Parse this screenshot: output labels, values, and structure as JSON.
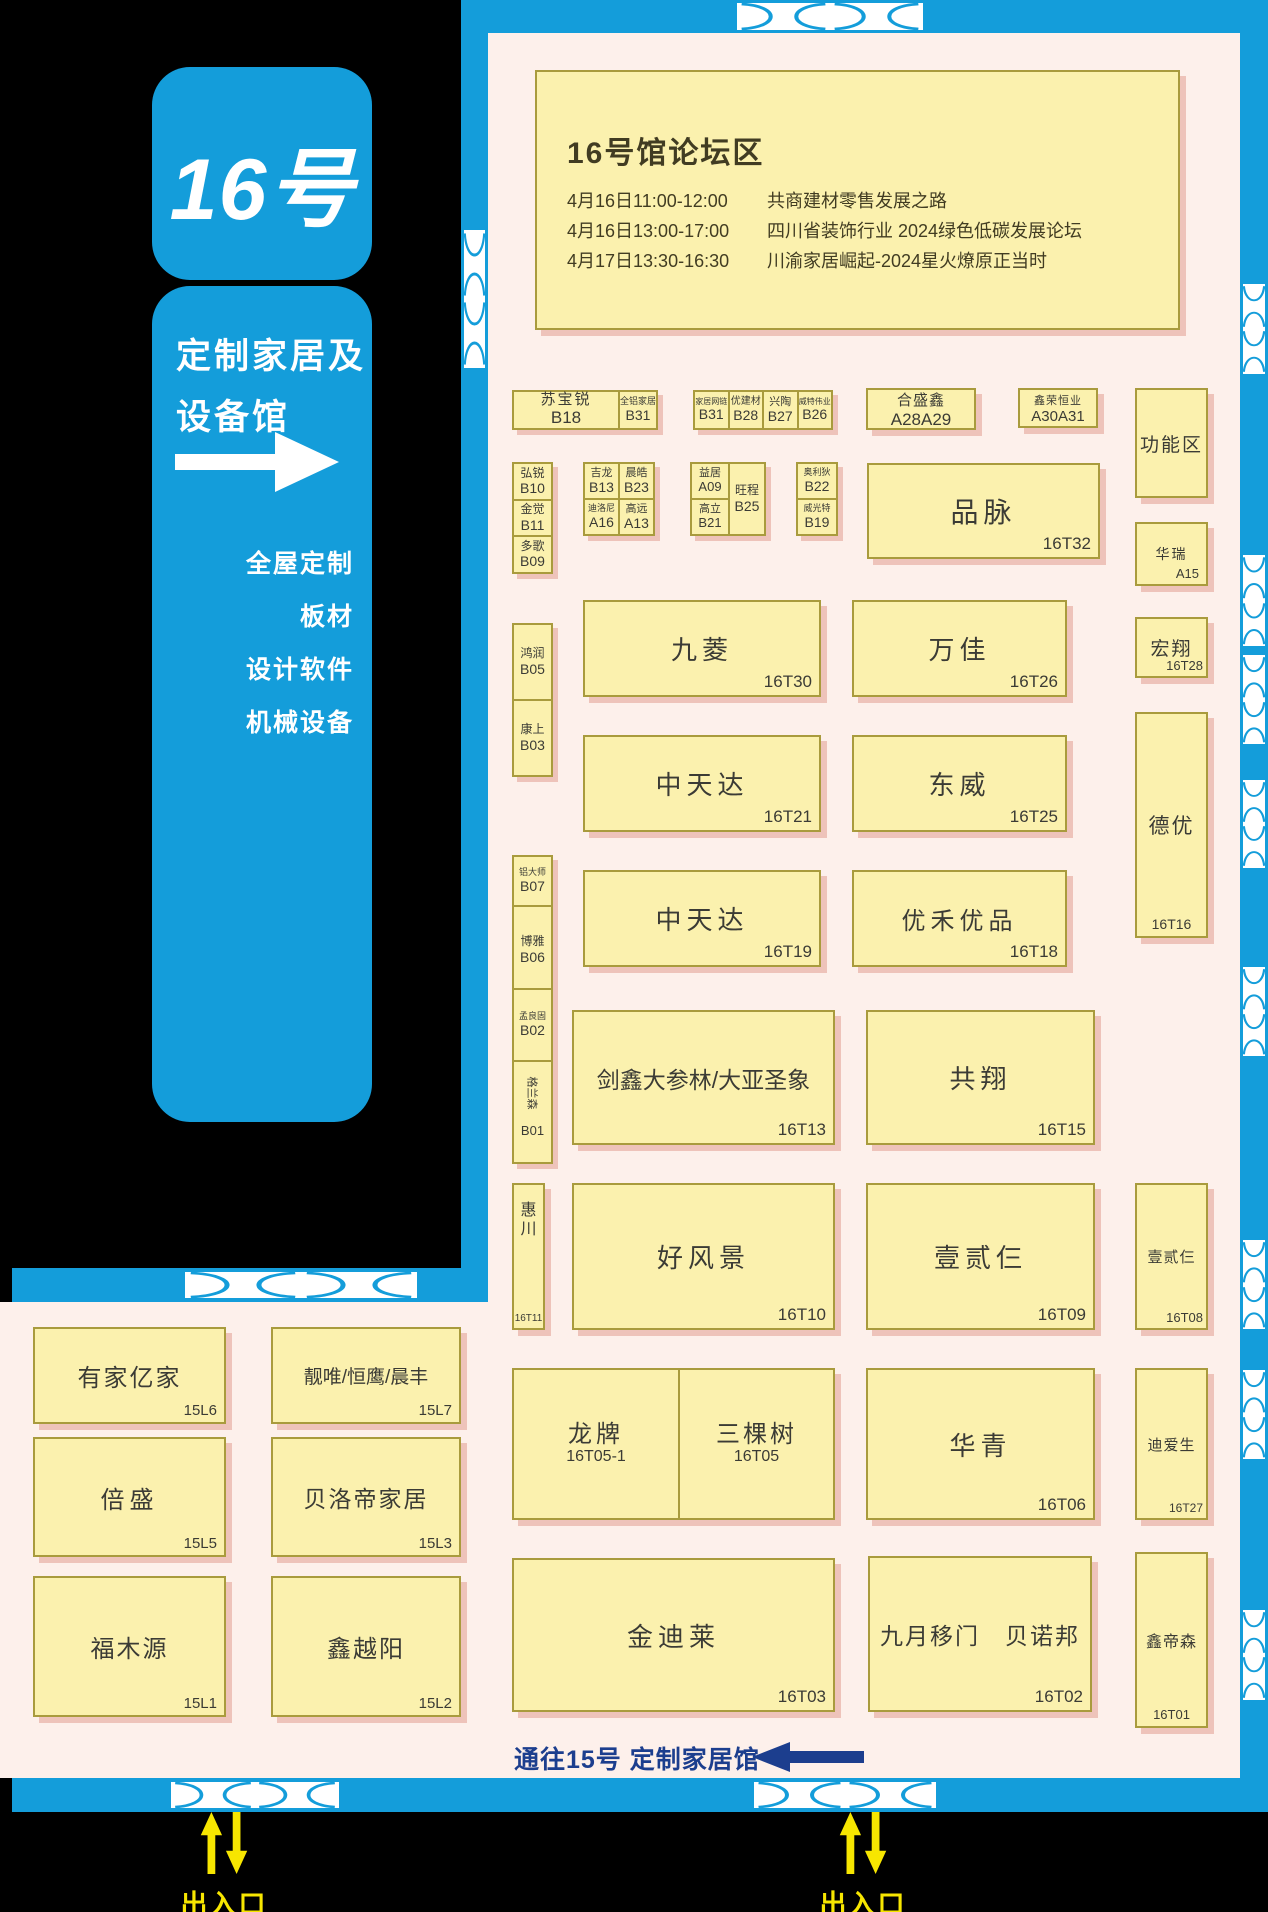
{
  "hall": {
    "number_label": "16号",
    "name_line1": "定制家居及",
    "name_line2": "设备馆",
    "categories": [
      "全屋定制",
      "板材",
      "设计软件",
      "机械设备"
    ]
  },
  "forum": {
    "title": "16号馆论坛区",
    "schedule": [
      {
        "time": "4月16日11:00-12:00",
        "topic": "共商建材零售发展之路"
      },
      {
        "time": "4月16日13:00-17:00",
        "topic": "四川省装饰行业 2024绿色低碳发展论坛"
      },
      {
        "time": "4月17日13:30-16:30",
        "topic": "川渝家居崛起-2024星火燎原正当时"
      }
    ]
  },
  "booths": {
    "subaorui": {
      "name": "苏宝锐",
      "id": "B18"
    },
    "quanlv": {
      "name": "全铝家居",
      "id": "B31"
    },
    "wanglian": {
      "name": "家居网链",
      "id": "B31"
    },
    "youjiancai": {
      "name": "优建材",
      "id": "B28"
    },
    "xingtao": {
      "name": "兴陶",
      "id": "B27"
    },
    "weiteweiye": {
      "name": "威特伟业",
      "id": "B26"
    },
    "heshengxin": {
      "name": "合盛鑫",
      "id": "A28A29"
    },
    "xinronghengye": {
      "name": "鑫荣恒业",
      "id": "A30A31"
    },
    "gongnengqu": {
      "name": "功能区",
      "id": ""
    },
    "hongrui": {
      "name": "弘锐",
      "id": "B10"
    },
    "jinjue": {
      "name": "金觉",
      "id": "B11"
    },
    "duoge": {
      "name": "多歌",
      "id": "B09"
    },
    "jilong": {
      "name": "吉龙",
      "id": "B13"
    },
    "chenhao": {
      "name": "晨皓",
      "id": "B23"
    },
    "diluoni": {
      "name": "迪洛尼",
      "id": "A16"
    },
    "gaoyuan": {
      "name": "高远",
      "id": "A13"
    },
    "yiju": {
      "name": "益居",
      "id": "A09"
    },
    "gaoli": {
      "name": "高立",
      "id": "B21"
    },
    "wangcheng": {
      "name": "旺程",
      "id": "B25"
    },
    "aolidi": {
      "name": "奥利狄",
      "id": "B22"
    },
    "weiguangte": {
      "name": "威光特",
      "id": "B19"
    },
    "pinmai": {
      "name": "品脉",
      "id": "16T32"
    },
    "hongrun": {
      "name": "鸿润",
      "id": "B05"
    },
    "kangshang": {
      "name": "康上",
      "id": "B03"
    },
    "lvdashi": {
      "name": "铝大师",
      "id": "B07"
    },
    "boya": {
      "name": "博雅",
      "id": "B06"
    },
    "menglianggu": {
      "name": "孟良固",
      "id": "B02"
    },
    "gelansen": {
      "name": "格兰森",
      "id": "B01"
    },
    "jiuling": {
      "name": "九菱",
      "id": "16T30"
    },
    "wanjia": {
      "name": "万佳",
      "id": "16T26"
    },
    "huarui": {
      "name": "华瑞",
      "id": "A15"
    },
    "zhongtianda_a": {
      "name": "中天达",
      "id": "16T21"
    },
    "dongwei": {
      "name": "东威",
      "id": "16T25"
    },
    "hongxiang": {
      "name": "宏翔",
      "id": "16T28"
    },
    "zhongtianda_b": {
      "name": "中天达",
      "id": "16T19"
    },
    "youheyoupin": {
      "name": "优禾优品",
      "id": "16T18"
    },
    "deyou": {
      "name": "德优",
      "id": "16T16"
    },
    "jianxin": {
      "name": "剑鑫大参林/大亚圣象",
      "id": "16T13"
    },
    "gongxiang": {
      "name": "共翔",
      "id": "16T15"
    },
    "huichuan": {
      "name": "惠川",
      "id": "16T11"
    },
    "haofengjing": {
      "name": "好风景",
      "id": "16T10"
    },
    "yiersan_a": {
      "name": "壹贰仨",
      "id": "16T09"
    },
    "yiersan_b": {
      "name": "壹贰仨",
      "id": "16T08"
    },
    "longpai": {
      "name": "龙牌",
      "id": "16T05-1"
    },
    "sankeshu": {
      "name": "三棵树",
      "id": "16T05"
    },
    "huaqing": {
      "name": "华青",
      "id": "16T06"
    },
    "diaisheng": {
      "name": "迪爱生",
      "id": "16T27"
    },
    "jindilai": {
      "name": "金迪莱",
      "id": "16T03"
    },
    "jiuyue": {
      "name": "九月移门　贝诺邦",
      "id": "16T02"
    },
    "xindisen": {
      "name": "鑫帝森",
      "id": "16T01"
    },
    "youjiayijia": {
      "name": "有家亿家",
      "id": "15L6"
    },
    "liangwei": {
      "name": "靓唯/恒鹰/晨丰",
      "id": "15L7"
    },
    "beisheng": {
      "name": "倍盛",
      "id": "15L5"
    },
    "beiluodi": {
      "name": "贝洛帝家居",
      "id": "15L3"
    },
    "fumuyuan": {
      "name": "福木源",
      "id": "15L1"
    },
    "xinyueyang": {
      "name": "鑫越阳",
      "id": "15L2"
    }
  },
  "passage": {
    "text": "通往15号 定制家居馆"
  },
  "entrances": [
    {
      "label": "出入口"
    },
    {
      "label": "出入口"
    }
  ],
  "colors": {
    "wall_blue": "#149dda",
    "map_bg": "#fdf0eb",
    "booth_fill": "#fbf1ae",
    "booth_border": "#a99b3d",
    "booth_shadow": "#eec3ba",
    "navy": "#1c3e8e",
    "entrance_yellow": "#f7e600",
    "text_dark": "#3b3b35"
  }
}
